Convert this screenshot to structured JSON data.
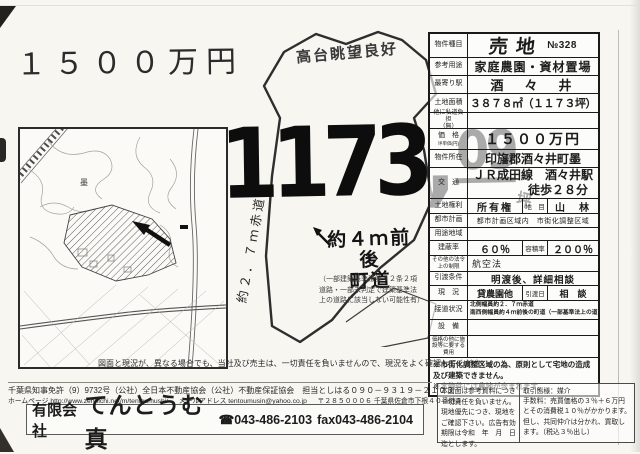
{
  "page": {
    "price": "１５００万円",
    "view_note": "高台眺望良好"
  },
  "parcel": {
    "area_main": "1173",
    "area_comma": ",",
    "area_dec": "09",
    "area_unit": "坪",
    "red_road": "約２．７ｍ赤道",
    "town_road1": "約４ｍ前後",
    "town_road2": "町道",
    "town_road_note": "（一部建築基準法第４２条２項道路・一部未判定で建築基準法上の道路に該当しない可能性有）"
  },
  "map": {
    "label": "墨"
  },
  "spec": {
    "type": {
      "label": "物件種目",
      "value": "売地",
      "no": "№328"
    },
    "use": {
      "label": "参考用途",
      "value": "家庭農園・資材置場"
    },
    "station": {
      "label": "最寄り駅",
      "value": "酒　々　井"
    },
    "area": {
      "label": "土地面積",
      "value": "３８７８㎡（１１７３坪）"
    },
    "private_road": {
      "label": "他に私道負担",
      "sub": "（無）",
      "value": ""
    },
    "price": {
      "label": "価　格",
      "sublabel": "坪単価(円)",
      "value": "１５００万円"
    },
    "location": {
      "label": "物件所在",
      "value": "印旛郡酒々井町墨"
    },
    "access": {
      "label": "交　通",
      "line1": "ＪＲ成田線　酒々井駅",
      "line2": "徒歩２８分"
    },
    "rights": {
      "label": "土地権利",
      "value": "所有権",
      "sublabel": "地　目",
      "subvalue": "山　林"
    },
    "city_plan": {
      "label": "都市計画",
      "value": "都市計画区域内　市街化調整区域"
    },
    "zoning": {
      "label": "用途地域",
      "value": ""
    },
    "coverage": {
      "label": "建蔽率",
      "value": "６０％",
      "sublabel": "容積率",
      "subvalue": "２００％"
    },
    "other_law": {
      "label": "その他の法令上の制限",
      "value": "航空法"
    },
    "handover": {
      "label": "引渡条件",
      "value": "明渡後、詳細相談"
    },
    "status": {
      "label": "現　況",
      "value": "貸農園他",
      "sublabel": "引渡日",
      "subvalue": "相　談"
    },
    "frontage": {
      "label": "接道状況",
      "line1": "北側幅員約２．７ｍ赤道",
      "line2": "南西側幅員約４ｍ前後の町道（一部基準法上の道"
    },
    "equipment": {
      "label": "設　備",
      "value": ""
    },
    "extra_cost": {
      "label": "価格の他に施設等に要する費用",
      "value": ""
    },
    "note1": "※市街化調整区域の為、原則として宅地の造成及び建築できません。",
    "note2": "※本物件には農地が含まれます。"
  },
  "terms": {
    "left": "本図面は参考資料につき一切責任を負いません。現地優先につき、現地をご確認下さい。広告有効期限は令和　年　月　日迄とします。",
    "right1": "取引態様：媒介",
    "right2": "手数料：売買価格の３％＋６万円とその消費税１０％がかかります。但し、共同仲介は分かれ、買取します。（税込３％出し）"
  },
  "footer": {
    "disclaimer": "図面と現況が、異なる場合でも、当社及び売主は、一切責任を負いませんので、現況をよく確認してください。",
    "license": "千葉県知事免許（9）9732号（公社）全日本不動産協会（公社）不動産保証協会　担当としはる０９０－９３１９－２１０３",
    "homepage_label": "ホームページ",
    "homepage_url": "http://www.zennichi.net/m/tentoumushi/",
    "email_label": "メールアドレス",
    "email": "tentoumusin@yahoo.co.jp",
    "postal": "〒２８５０００６",
    "address": "千葉県佐倉市下根４０番地３",
    "company_prefix": "有限会社",
    "company_name": "てんとうむ真",
    "tel": "☎043-486-2103",
    "fax": "fax043-486-2104"
  },
  "colors": {
    "ink": "#1c1c1c",
    "paper": "#f7f6f1"
  }
}
